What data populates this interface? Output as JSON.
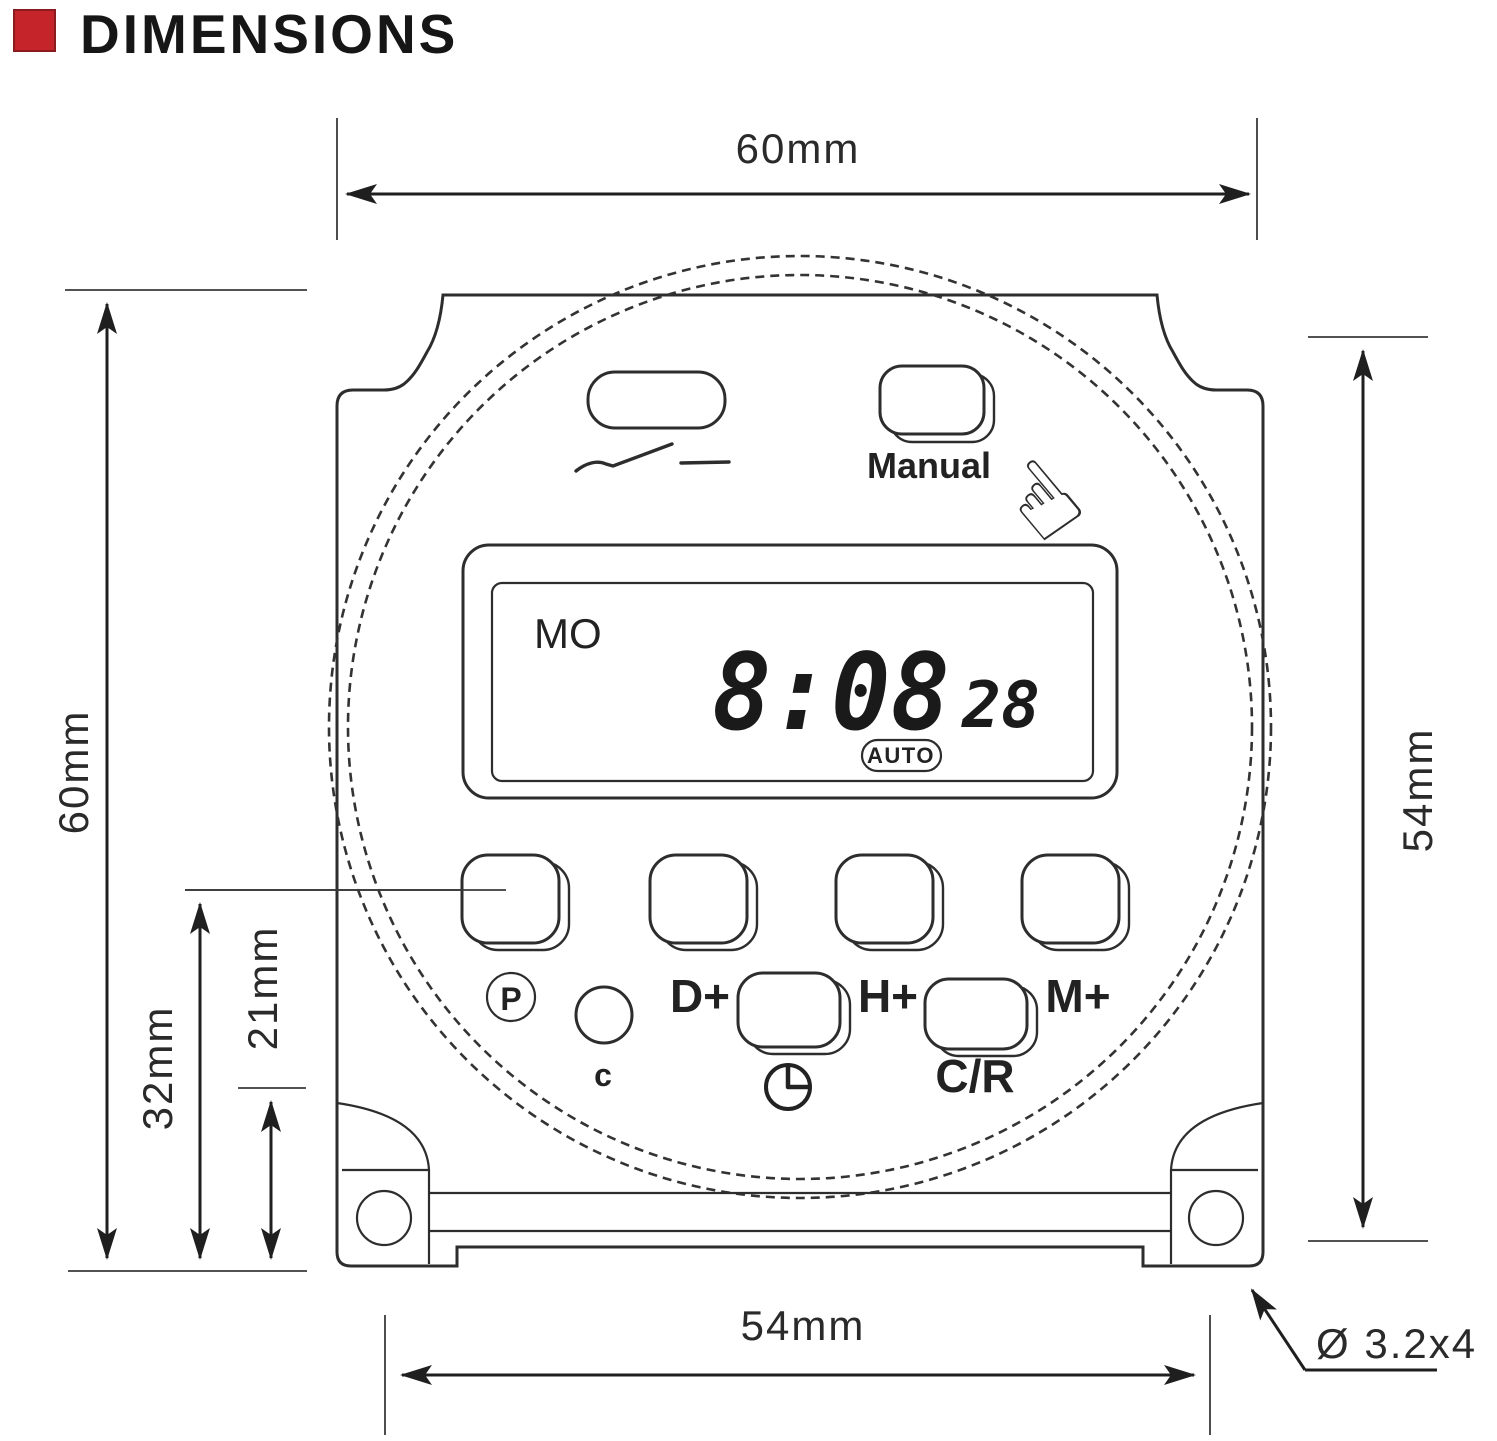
{
  "title": {
    "text": "DIMENSIONS",
    "accent_color": "#c5242a"
  },
  "dimensions": {
    "top_width": "60mm",
    "left_height": "60mm",
    "left_lower": "32mm",
    "left_inner": "21mm",
    "right_height": "54mm",
    "bottom_width": "54mm",
    "mounting_hole": "Ø 3.2x4"
  },
  "device": {
    "manual_button_label": "Manual",
    "hand_glyph": "☝",
    "lcd": {
      "day": "MO",
      "time": "8:08",
      "seconds": "28",
      "mode_badge": "AUTO"
    },
    "buttons_row1": [
      {
        "label": "P"
      },
      {
        "label": "D+"
      },
      {
        "label": "H+"
      },
      {
        "label": "M+"
      }
    ],
    "buttons_row2": [
      {
        "label": "c"
      },
      {
        "label": "clock-icon"
      },
      {
        "label": "C/R"
      }
    ]
  }
}
